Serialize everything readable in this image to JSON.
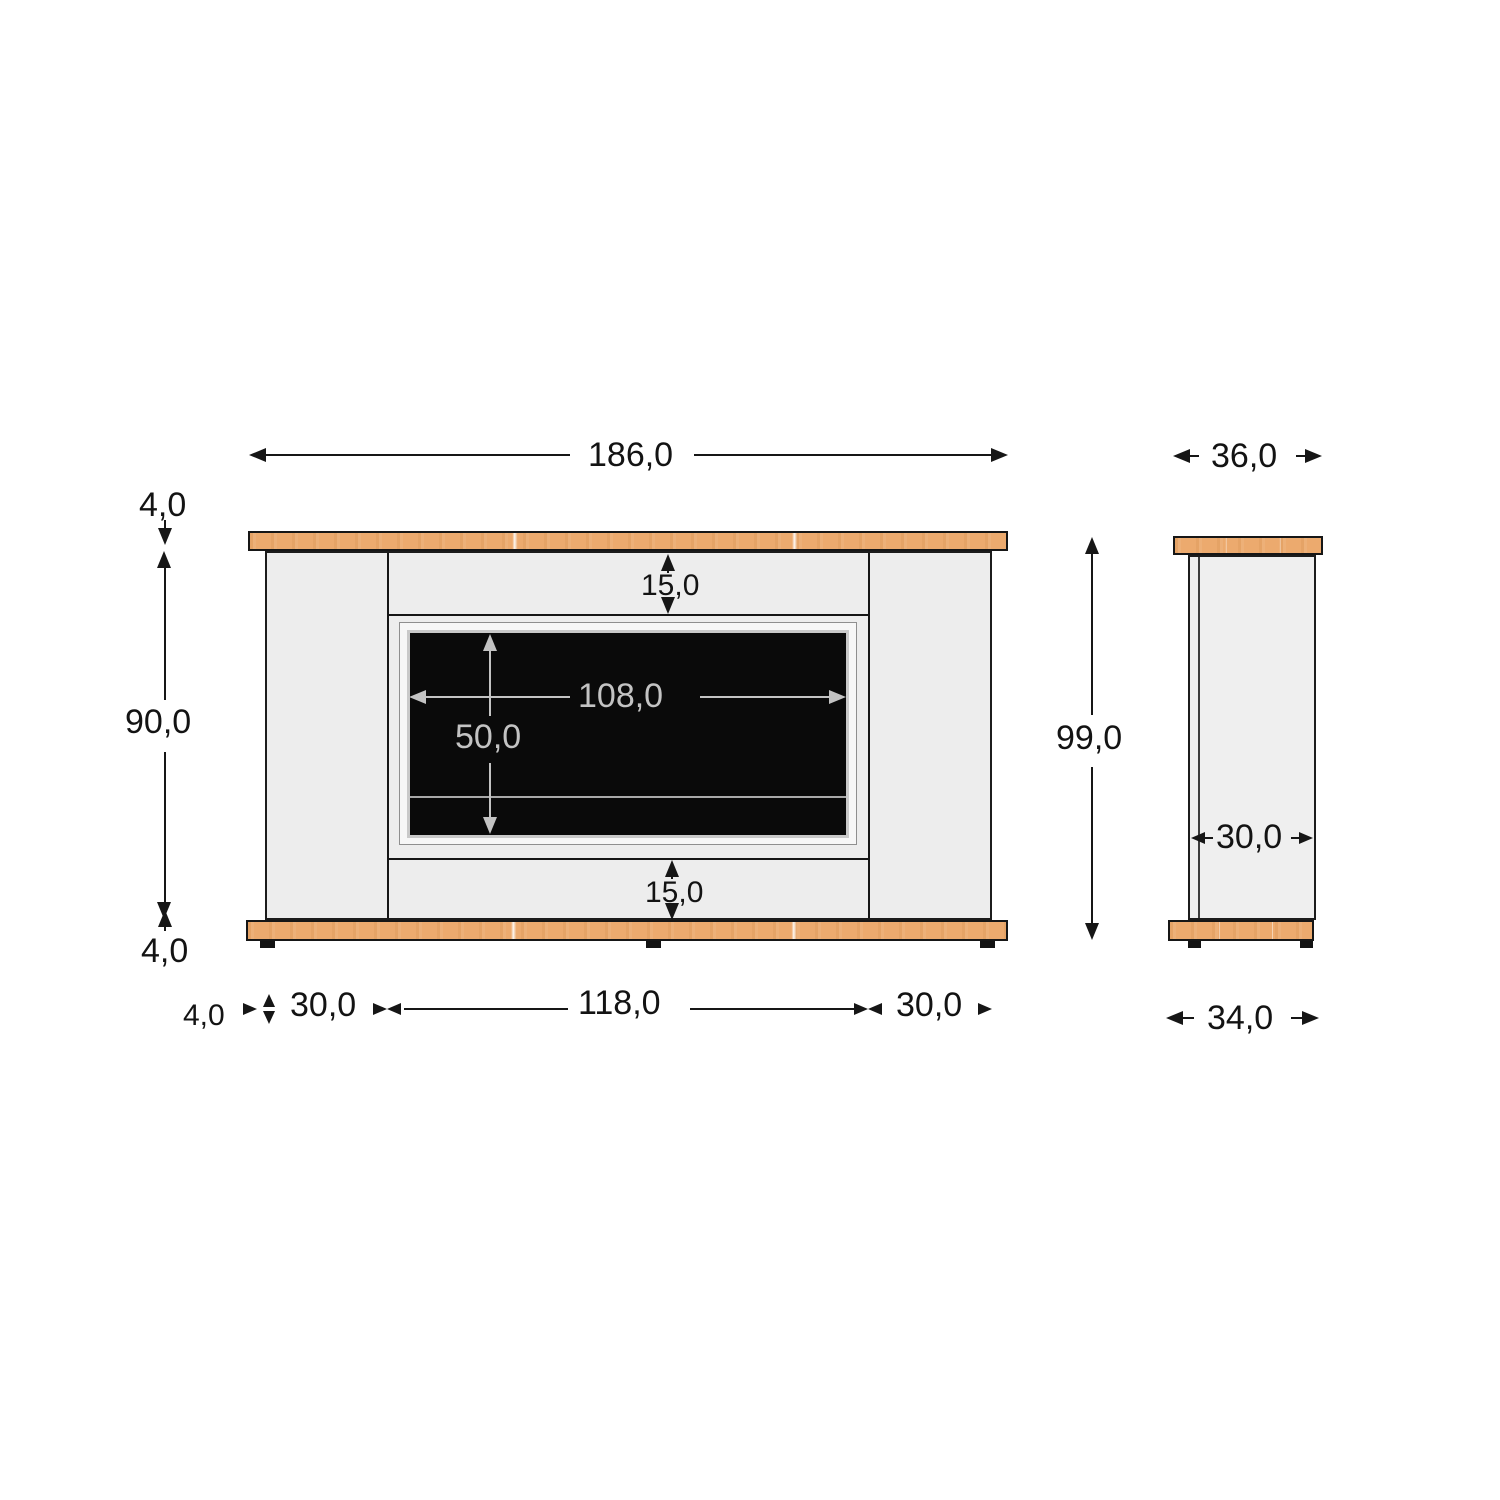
{
  "drawing_type": "furniture-dimension-drawing",
  "dims": {
    "front_overall_width": "186,0",
    "front_top_board_thickness": "4,0",
    "front_body_height": "90,0",
    "front_bottom_board_thickness": "4,0",
    "front_top_reveal": "15,0",
    "front_opening_width": "108,0",
    "front_opening_height": "50,0",
    "front_bottom_reveal": "15,0",
    "front_board_overhang": "4,0",
    "front_left_column_width": "30,0",
    "front_center_width": "118,0",
    "front_right_column_width": "30,0",
    "side_overall_depth": "36,0",
    "side_overall_height": "99,0",
    "side_body_depth": "30,0",
    "side_base_depth": "34,0"
  },
  "colors": {
    "wood": "#ecaa6e",
    "panel": "#ededed",
    "inner_frame": "#f7f7f7",
    "screen": "#0a0a0a",
    "outline": "#161616",
    "dim_dark": "#131313",
    "dim_light": "#c3c3c3",
    "background": "#ffffff"
  }
}
